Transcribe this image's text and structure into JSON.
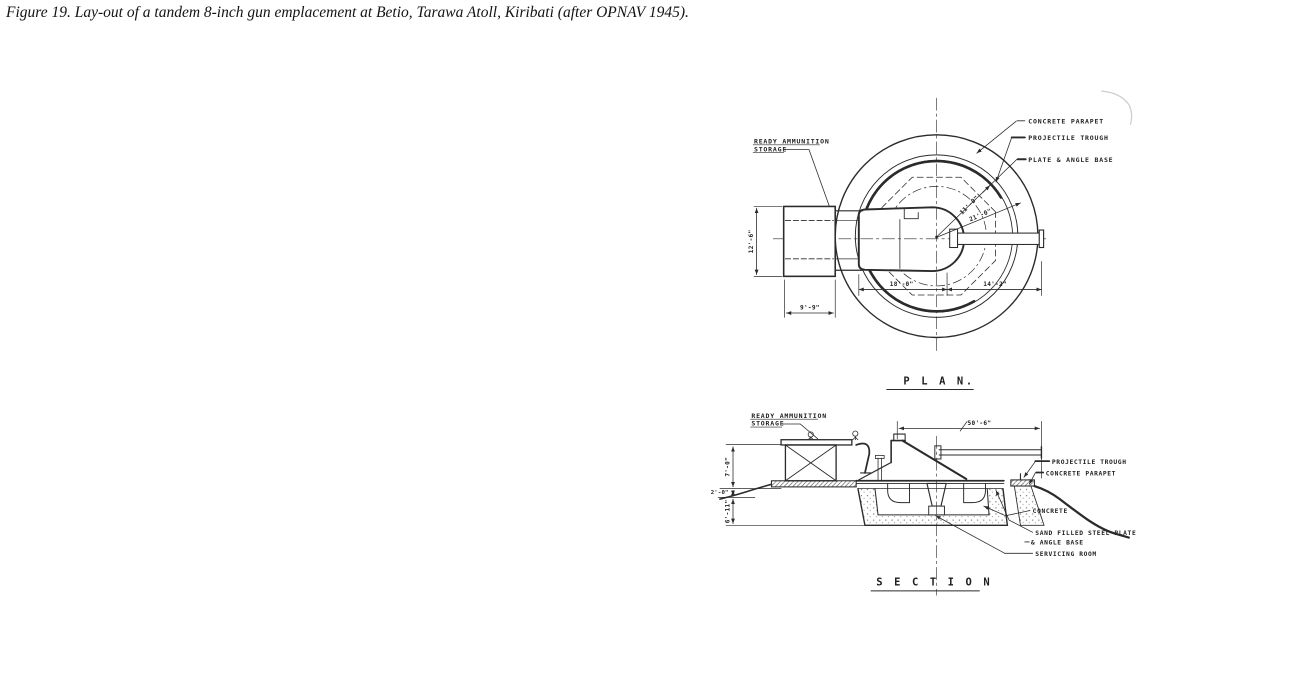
{
  "colors": {
    "ink": "#2b2b2b",
    "paper": "#ffffff"
  },
  "caption": {
    "text": "Figure 19. Lay-out of a tandem 8-inch gun emplacement at Betio, Tarawa Atoll, Kiribati (after OPNAV 1945)."
  },
  "plan": {
    "title": "P L A N.",
    "labels": {
      "ready_ammo_1": "READY AMMUNITION",
      "ready_ammo_2": "STORAGE",
      "concrete_parapet": "CONCRETE PARAPET",
      "projectile_trough": "PROJECTILE TROUGH",
      "plate_angle_base": "PLATE & ANGLE BASE"
    },
    "dims": {
      "radius_inner": "11'-0\"",
      "radius_outer": "21'-0\"",
      "span_left": "18'-0\"",
      "span_right": "14'-2\"",
      "storage_length": "12'-6\"",
      "storage_width": "9'-9\""
    }
  },
  "section": {
    "title": "S E C T I O N",
    "labels": {
      "ready_ammo_1": "READY AMMUNITION",
      "ready_ammo_2": "STORAGE",
      "projectile_trough": "PROJECTILE TROUGH",
      "concrete_parapet": "CONCRETE PARAPET",
      "concrete": "CONCRETE",
      "sand_filled_plate": "SAND FILLED STEEL PLATE",
      "angle_base": "& ANGLE BASE",
      "servicing_room": "SERVICING ROOM"
    },
    "dims": {
      "overall_width": "50'-6\"",
      "storage_height": "7'-0\"",
      "parapet_height": "2'-0\"",
      "pit_depth": "6'-11\""
    }
  }
}
